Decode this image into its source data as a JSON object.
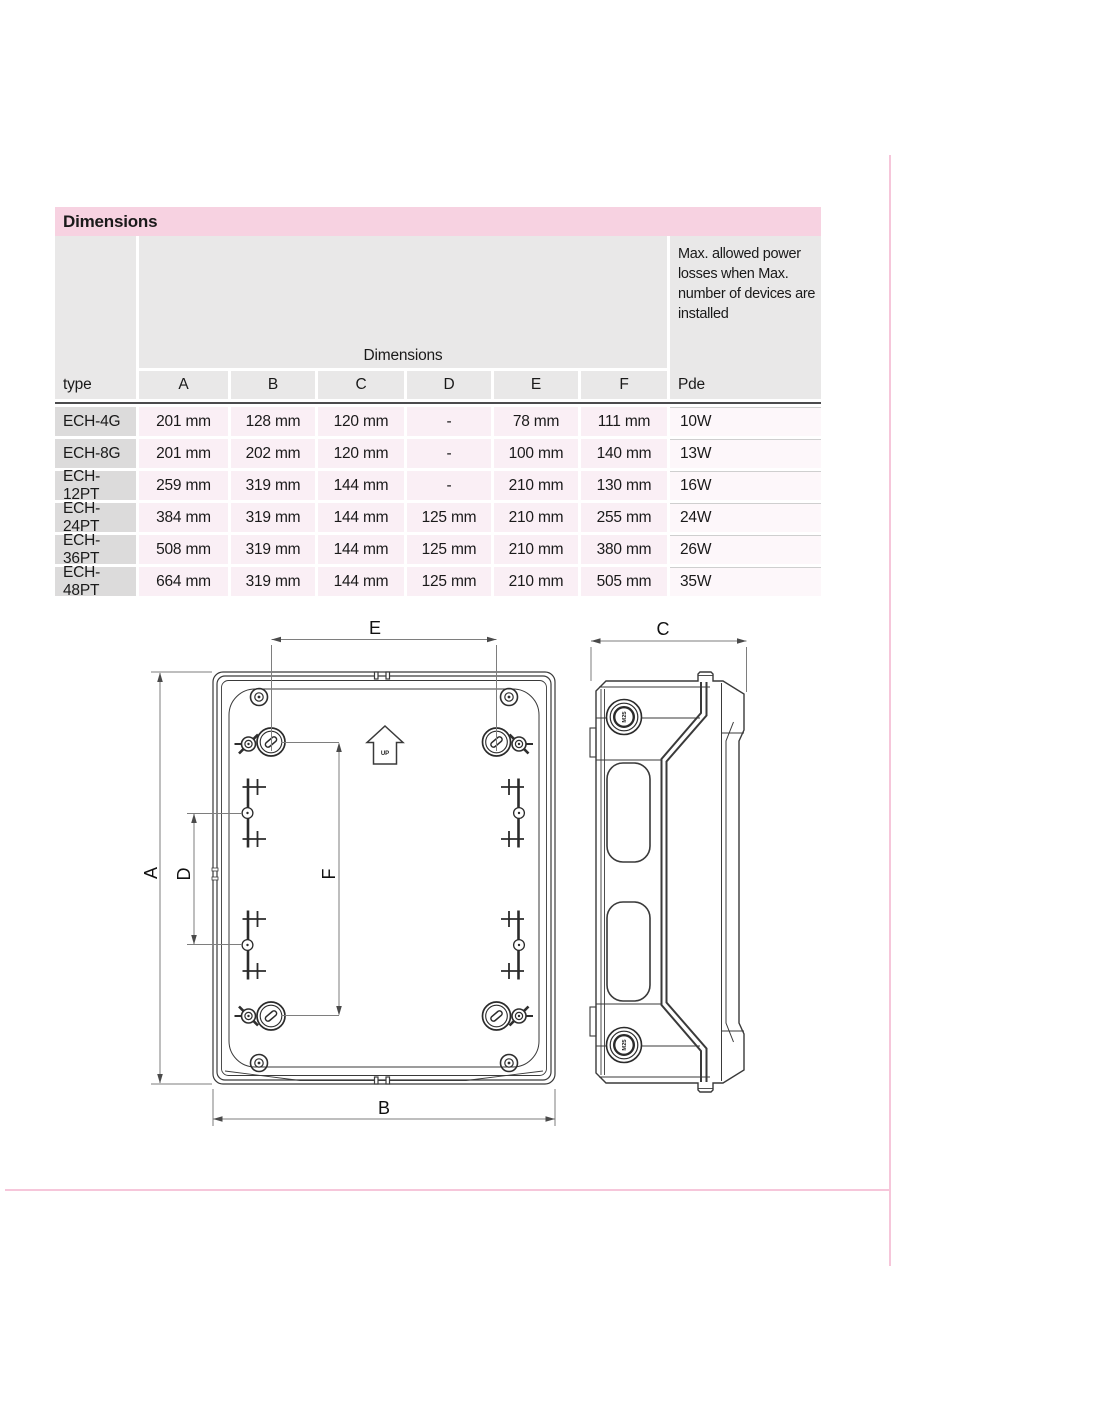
{
  "document": {
    "section_title": "Dimensions"
  },
  "table": {
    "header": {
      "type_label": "type",
      "dimensions_label": "Dimensions",
      "power_note": "Max. allowed power losses when Max. number of devices are installed",
      "columns": [
        "A",
        "B",
        "C",
        "D",
        "E",
        "F"
      ],
      "pde_label": "Pde"
    },
    "rows": [
      {
        "type": "ECH-4G",
        "a": "201 mm",
        "b": "128 mm",
        "c": "120 mm",
        "d": "-",
        "e": "78 mm",
        "f": "111 mm",
        "pde": "10W"
      },
      {
        "type": "ECH-8G",
        "a": "201 mm",
        "b": "202 mm",
        "c": "120 mm",
        "d": "-",
        "e": "100 mm",
        "f": "140 mm",
        "pde": "13W"
      },
      {
        "type": "ECH-12PT",
        "a": "259 mm",
        "b": "319 mm",
        "c": "144 mm",
        "d": "-",
        "e": "210 mm",
        "f": "130 mm",
        "pde": "16W"
      },
      {
        "type": "ECH-24PT",
        "a": "384 mm",
        "b": "319 mm",
        "c": "144 mm",
        "d": "125 mm",
        "e": "210 mm",
        "f": "255 mm",
        "pde": "24W"
      },
      {
        "type": "ECH-36PT",
        "a": "508 mm",
        "b": "319 mm",
        "c": "144 mm",
        "d": "125 mm",
        "e": "210 mm",
        "f": "380 mm",
        "pde": "26W"
      },
      {
        "type": "ECH-48PT",
        "a": "664 mm",
        "b": "319 mm",
        "c": "144 mm",
        "d": "125 mm",
        "e": "210 mm",
        "f": "505 mm",
        "pde": "35W"
      }
    ]
  },
  "drawing": {
    "dimension_labels": {
      "a": "A",
      "b": "B",
      "c": "C",
      "d": "D",
      "e": "E",
      "f": "F"
    },
    "up_label": "UP",
    "knockout_label": "M25"
  },
  "colors": {
    "accent_pink": "#f7d2e1",
    "row_pink": "#faeff5",
    "header_gray": "#e9e8e8",
    "type_gray": "#dcdbdb",
    "rule_dark": "#4b4b4d",
    "guide_pink": "#f6c6da"
  }
}
